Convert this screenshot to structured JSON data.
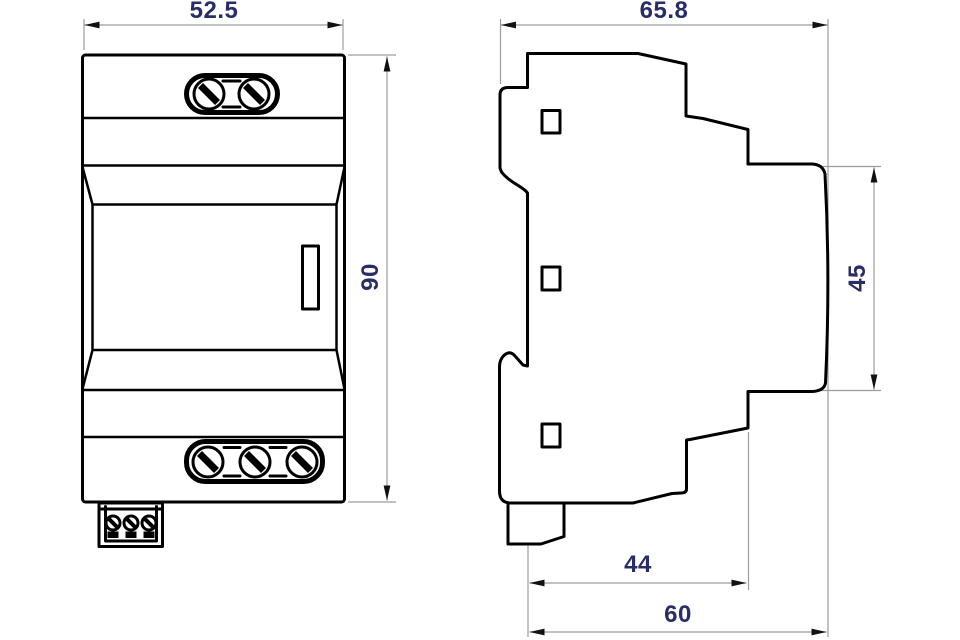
{
  "drawing": {
    "description": "Two-view technical dimension drawing of a DIN-rail mounted enclosure (front view and side profile)",
    "unit": "mm",
    "scale_px_per_mm": 5
  },
  "colors": {
    "background": "#ffffff",
    "outline": "#000000",
    "dimension_line": "#9c9c9c",
    "arrow": "#111111",
    "dimension_text": "#292d66"
  },
  "dims": {
    "front_width": "52.5",
    "front_height": "90",
    "side_width": "65.8",
    "side_face_height": "45",
    "side_body_depth": "44",
    "side_total_depth": "60"
  }
}
